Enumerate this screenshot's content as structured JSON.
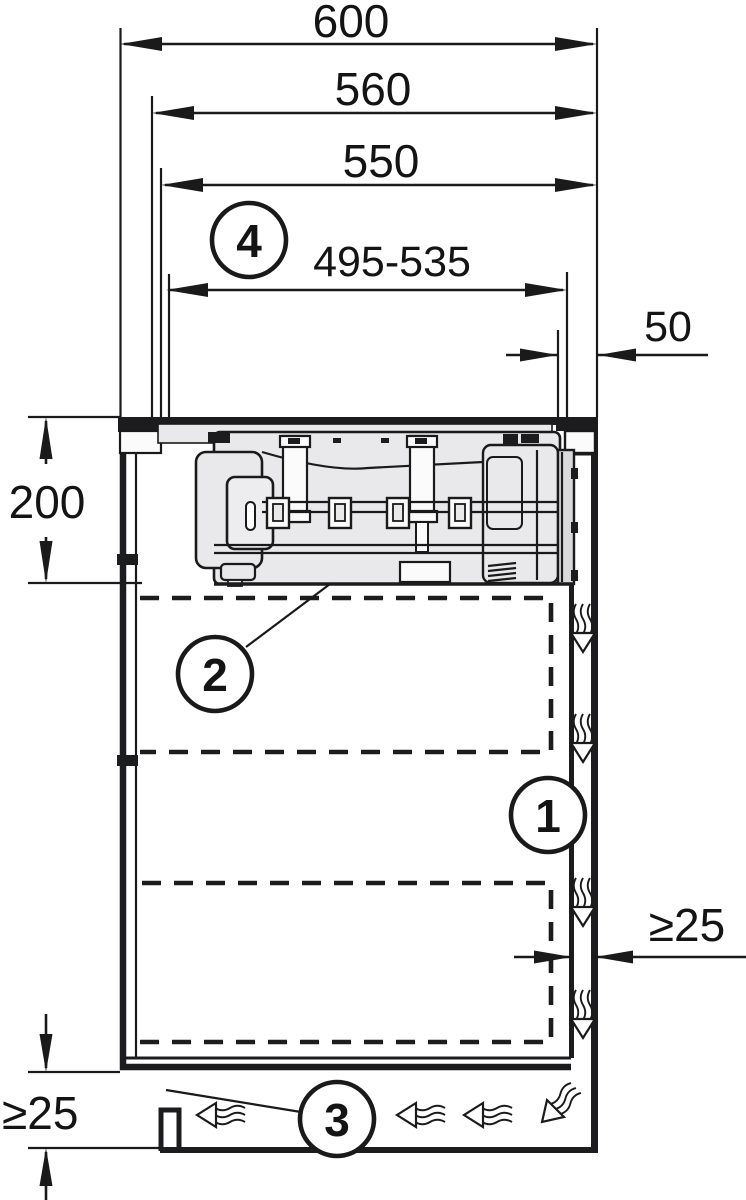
{
  "figure": {
    "type": "installation-cross-section-diagram",
    "background": "#ffffff",
    "line_color": "#1a1a1a",
    "appliance_fill": "#e9e9eb",
    "dims": {
      "worktop_depth": "600",
      "cutout_depth": "560",
      "appliance_top_depth": "550",
      "duct_position_range": "495-535",
      "rear_offset": "50",
      "unit_height": "200",
      "rear_air_gap": "≥25",
      "plinth_air_gap": "≥25"
    },
    "callouts": {
      "air_channel": "1",
      "appliance_unit": "2",
      "plinth_outlet": "3",
      "duct_range": "4"
    }
  }
}
